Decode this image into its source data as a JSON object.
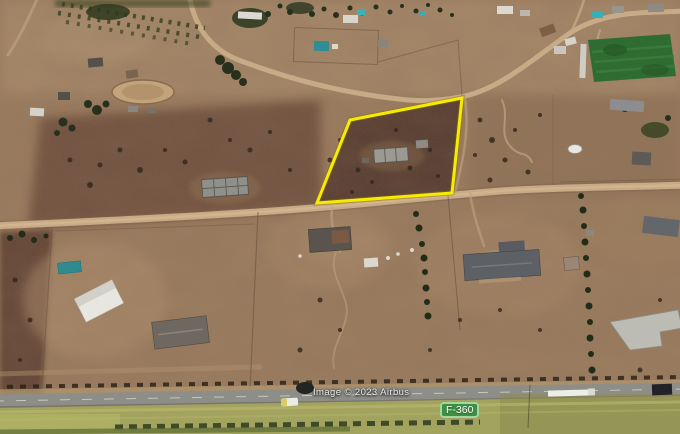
{
  "map": {
    "type": "satellite-aerial-view",
    "attribution": "Image © 2023 Airbus",
    "road_label": "F-360",
    "parcel": {
      "points": "350,120 462,98 452,193 317,203",
      "outline_color": "#f6ec00"
    },
    "colors": {
      "terrain_base": "#9c7d60",
      "parcel_dark_soil": "#50382d",
      "dirt_road": "#c7aa86",
      "highway_asphalt": "#8e8e88",
      "grass_verge": "#a2a35e",
      "vegetation_dark": "#2b3620",
      "sports_field_green": "#2f6c31",
      "road_badge_background": "#3e8e43",
      "road_badge_border": "#a3d6a2",
      "road_badge_text": "#ffffff"
    }
  }
}
